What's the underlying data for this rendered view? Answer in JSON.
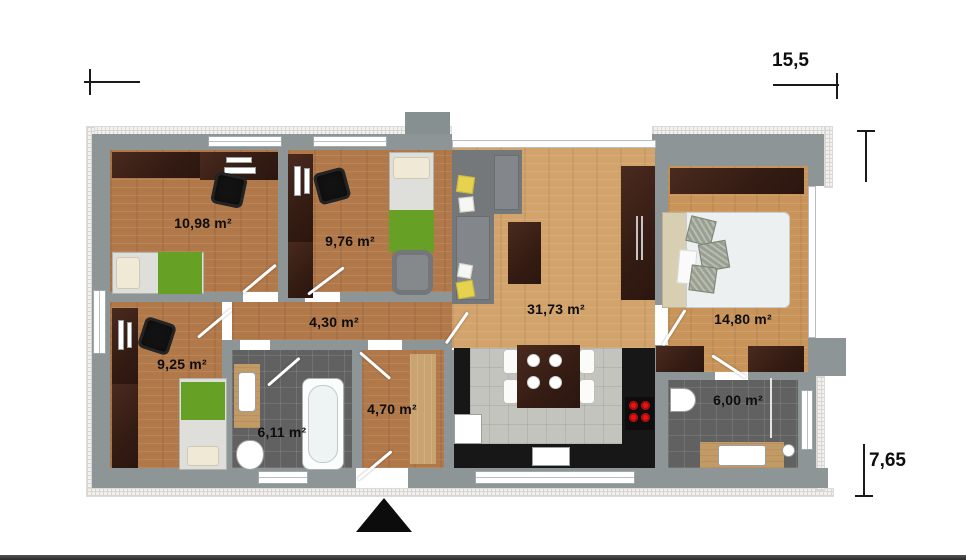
{
  "plan": {
    "name": "apartment-floor-plan",
    "dimensions": {
      "total_width": "15,5",
      "total_depth": "7,65"
    },
    "rooms": [
      {
        "id": "child-room-1",
        "area": "10,98 m²"
      },
      {
        "id": "child-room-2",
        "area": "9,76 m²"
      },
      {
        "id": "hallway",
        "area": "4,30 m²"
      },
      {
        "id": "child-room-3",
        "area": "9,25 m²"
      },
      {
        "id": "bathroom-1",
        "area": "6,11 m²"
      },
      {
        "id": "entrance-hall",
        "area": "4,70 m²"
      },
      {
        "id": "living-room-kitchen",
        "area": "31,73 m²"
      },
      {
        "id": "bedroom",
        "area": "14,80 m²"
      },
      {
        "id": "bathroom-2",
        "area": "6,00 m²"
      }
    ],
    "icons": {
      "entrance_arrow": "triangle-up"
    },
    "colors": {
      "wall": "#8e9596",
      "insulation": "#f2f1ef",
      "wood_floor": "#b1784a",
      "living_floor": "#d2a36b",
      "bedroom_floor": "#c8945a",
      "dark_furniture": "#3a211b",
      "green_accent": "#66a025",
      "bath_tile": "#616161",
      "kitchen_tile": "#c4c4bf",
      "counter_black": "#171717",
      "burner_red": "#e81414",
      "label_text": "#0d0d0d"
    }
  }
}
